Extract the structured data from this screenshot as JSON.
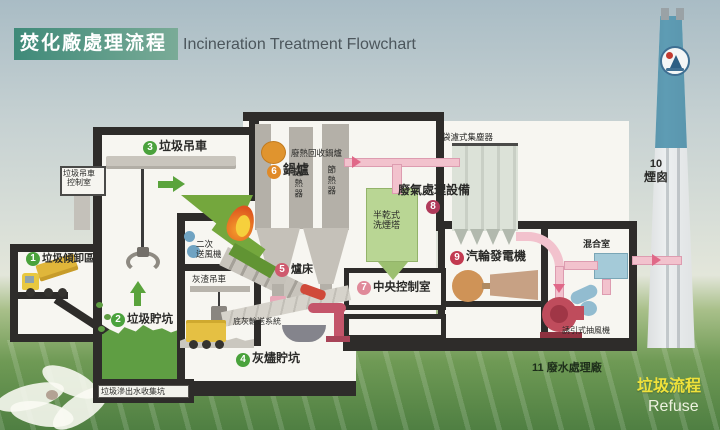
{
  "title": {
    "zh": "焚化廠處理流程",
    "en": "Incineration Treatment Flowchart"
  },
  "stations": [
    {
      "num": "1",
      "label": "垃圾傾卸區"
    },
    {
      "num": "2",
      "label": "垃圾貯坑"
    },
    {
      "num": "3",
      "label": "垃圾吊車"
    },
    {
      "num": "4",
      "label": "灰燼貯坑"
    },
    {
      "num": "5",
      "label": "爐床"
    },
    {
      "num": "6",
      "label": "鍋爐"
    },
    {
      "num": "7",
      "label": "中央控制室"
    },
    {
      "num": "8",
      "label": "廢氣處理設備"
    },
    {
      "num": "9",
      "label": "汽輪發電機"
    },
    {
      "num": "10",
      "label": "煙囪"
    },
    {
      "num": "11",
      "label": "廢水處理廠"
    }
  ],
  "sublabels": {
    "crane_control_line1": "垃圾吊車",
    "crane_control_line2": "控制室",
    "leachate_pit": "垃圾滲出水收集坑",
    "heat_recovery_boiler": "廢熱回收鍋爐",
    "superheater": "過熱器",
    "economizer": "節熱器",
    "secondary_fan_line1": "二次",
    "secondary_fan_line2": "送風機",
    "ash_crane": "灰渣吊車",
    "bottom_ash_conveyor": "底灰輸送系統",
    "bag_filter": "袋濾式集塵器",
    "scrubber_line1": "半乾式",
    "scrubber_line2": "洗煙塔",
    "mixing_chamber": "混合室",
    "induced_draft_fan": "誘引式抽風機"
  },
  "legend": {
    "zh": "垃圾流程",
    "en": "Refuse"
  },
  "colors": {
    "title_band": "#3f8a79",
    "station_green": "#4aa23c",
    "station_orange": "#e08a28",
    "station_red": "#c23a50",
    "pipe_pink": "#f2c2cd",
    "flow_arrow_green": "#5aa33c",
    "legend_yellow": "#f0e23a",
    "chimney_blue": "#5e9cb4",
    "structure_dark": "#2e2c2a"
  }
}
